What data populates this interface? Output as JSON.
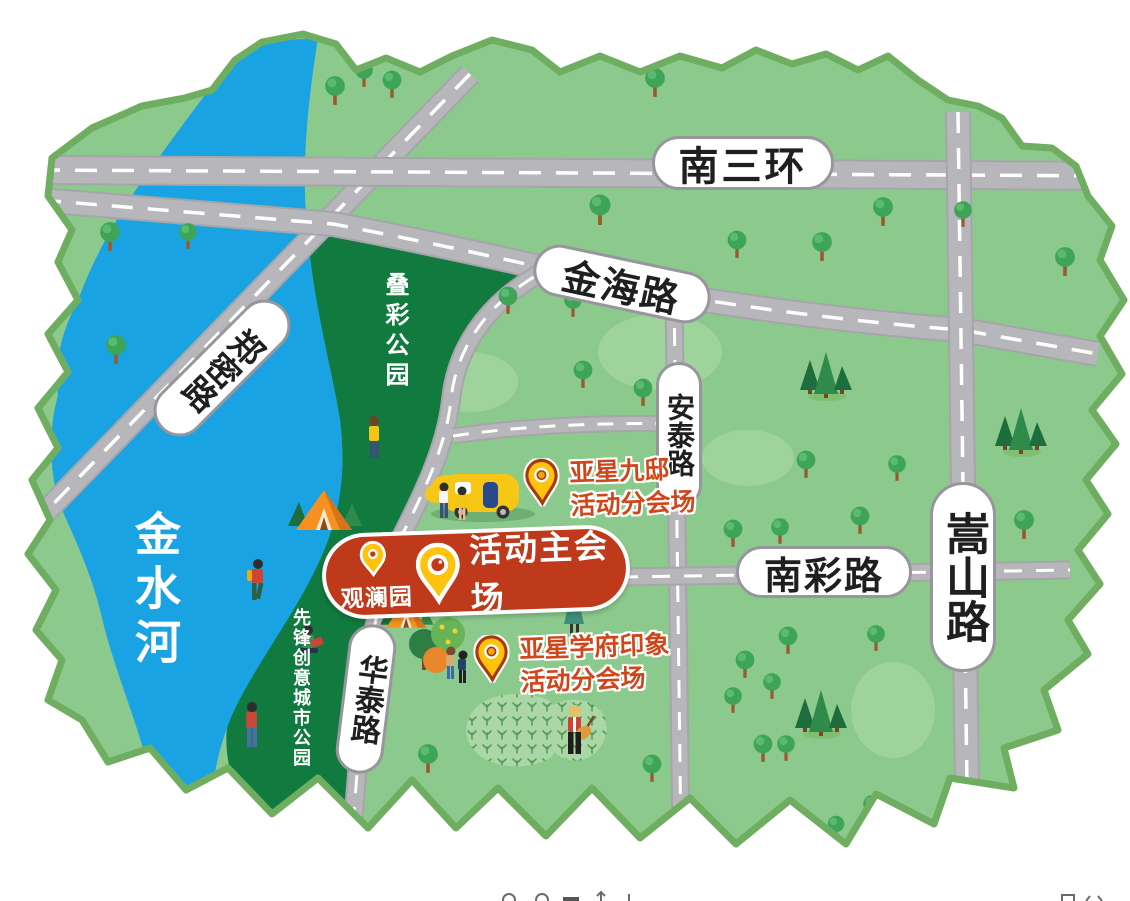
{
  "roads": {
    "nansanhuan": "南三环",
    "jinhai": "金海路",
    "zhengmi": "郑密路",
    "antai": "安泰路",
    "songshan": "嵩山路",
    "nancai": "南彩路",
    "huatai": "华泰路"
  },
  "river": {
    "name": "金水河"
  },
  "parks": {
    "diecai": "叠彩公园",
    "xianfeng": "先锋创意城市公园"
  },
  "venues": {
    "main": {
      "area_label": "观澜园",
      "title": "活动主会场"
    },
    "sub_jiudi": {
      "name": "亚星九邸",
      "subtitle": "活动分会场"
    },
    "sub_xuefu": {
      "name": "亚星学府印象",
      "subtitle": "活动分会场"
    }
  },
  "colors": {
    "map_fill": "#8cc98d",
    "map_border": "#6fae61",
    "park_fill": "#117a3e",
    "river_fill": "#1aa3e2",
    "road_fill": "#b7b6ba",
    "banner_red": "#bf3a1b",
    "pin_yellow": "#fdc30d",
    "venue_text_red": "#d0461b"
  }
}
